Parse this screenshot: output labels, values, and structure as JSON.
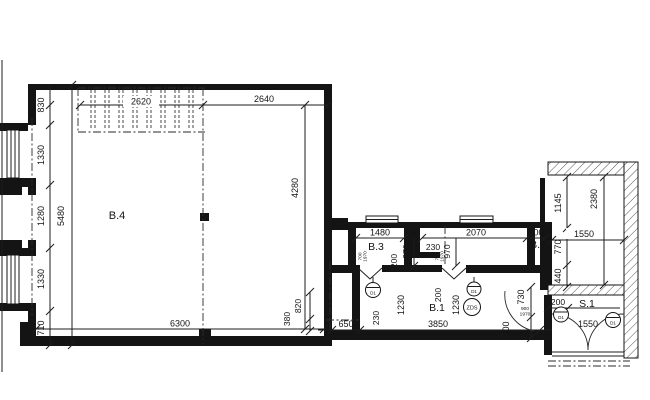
{
  "drawing": {
    "colors": {
      "background": "#ffffff",
      "line": "#141414"
    },
    "rooms": {
      "b4": "B.4",
      "b3": "B.3",
      "b1": "B.1",
      "b2": "B.2",
      "s1": "S.1"
    },
    "labels": {
      "dim_830": "830",
      "dim_1330_top": "1330",
      "dim_1280": "1280",
      "dim_1330_bottom": "1330",
      "dim_710": "710",
      "dim_5480": "5480",
      "dim_2620": "2620",
      "dim_2640": "2640",
      "dim_4280": "4280",
      "dim_6300": "6300",
      "dim_380": "380",
      "dim_820": "820",
      "dim_650": "650",
      "dim_230_b1": "230",
      "dim_1230_left": "1230",
      "dim_200_b1": "200",
      "dim_1230_right": "1230",
      "dim_3850": "3850",
      "dim_1480": "1480",
      "dim_970_b3": "970",
      "dim_200_b3": "200",
      "dim_230_stub": "230",
      "dim_2070": "2070",
      "dim_970_b2": "970",
      "dim_500_b2": "500",
      "dim_1145": "1145",
      "dim_770": "770",
      "dim_440": "440",
      "dim_1550_top": "1550",
      "dim_2380": "2380",
      "dim_730": "730",
      "dim_500_door": "500",
      "dim_200_s1": "200",
      "dim_1550_s1": "1550",
      "door_b3_w": "700",
      "door_b3_h": "1970",
      "door_b2_w": "700",
      "door_b2_h": "1970",
      "door_s1_w": "900",
      "door_s1_h": "1970",
      "tag_zds": "ZDS",
      "tag_d1_left": "D1",
      "tag_d1_mid": "D1",
      "tag_d1_s1_left": "D1",
      "tag_d1_s1_right": "D1"
    }
  }
}
